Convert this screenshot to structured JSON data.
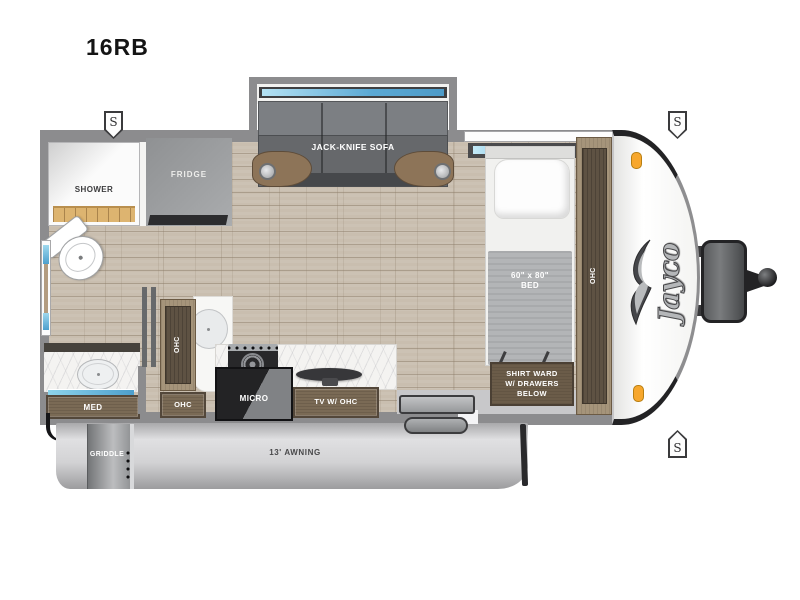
{
  "title": "16RB",
  "brand": {
    "logo_text": "Jayco"
  },
  "markers": {
    "speaker": "S"
  },
  "slideout": {
    "sofa": "JACK-KNIFE SOFA"
  },
  "bathroom": {
    "shower": "SHOWER",
    "med_cabinet": "MED"
  },
  "kitchen": {
    "fridge": "FRIDGE",
    "ohc_tall": "OHC",
    "ohc_drawer": "OHC",
    "microwave": "MICRO",
    "tv_cabinet": "TV W/ OHC"
  },
  "bedroom": {
    "bed_size": "60\" x 80\"",
    "bed": "BED",
    "wardrobe_ohc": "OHC",
    "shirt_ward": [
      "SHIRT WARD",
      "W/ DRAWERS",
      "BELOW"
    ]
  },
  "exterior": {
    "awning": "13' AWNING",
    "griddle": "GRIDDLE"
  },
  "colors": {
    "wall_gray": "#8c8c8e",
    "floor_wood": "#c9beaf",
    "window_blue": "#5ba9d4",
    "cabinet_wood": "#7a6a55",
    "marker_orange": "#f7a72d",
    "awning_gray": "#d4d4d6",
    "sofa_gray": "#6b6d70"
  }
}
